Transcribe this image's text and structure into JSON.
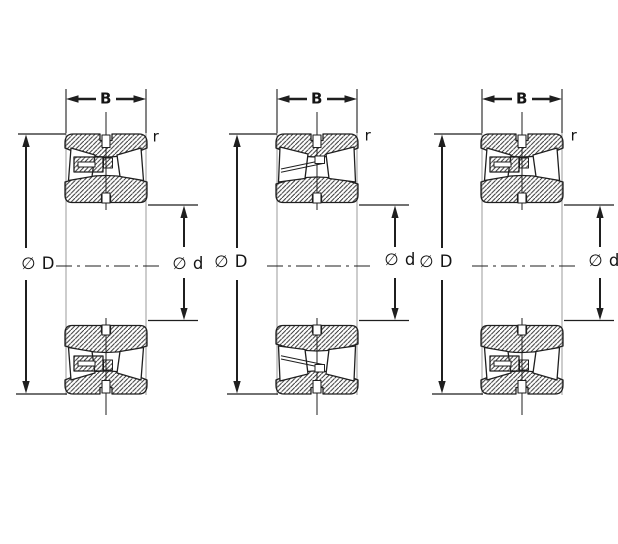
{
  "drawing": {
    "type": "bearing-dimension-diagram",
    "background": "#ffffff",
    "line_color": "#1f1f1f",
    "face_line_color": "#9b9b9b",
    "figures": [
      {
        "id": "bearing-1",
        "variant": "with-center-guide-flange",
        "labels": {
          "width": "B",
          "corner_radius": "r",
          "outer_diameter": "∅ D",
          "bore_diameter": "∅ d"
        }
      },
      {
        "id": "bearing-2",
        "variant": "open-cage",
        "labels": {
          "width": "B",
          "corner_radius": "r",
          "outer_diameter": "∅ D",
          "bore_diameter": "∅ d"
        }
      },
      {
        "id": "bearing-3",
        "variant": "with-center-guide-flange",
        "labels": {
          "width": "B",
          "corner_radius": "r",
          "outer_diameter": "∅ D",
          "bore_diameter": "∅ d"
        }
      }
    ]
  }
}
